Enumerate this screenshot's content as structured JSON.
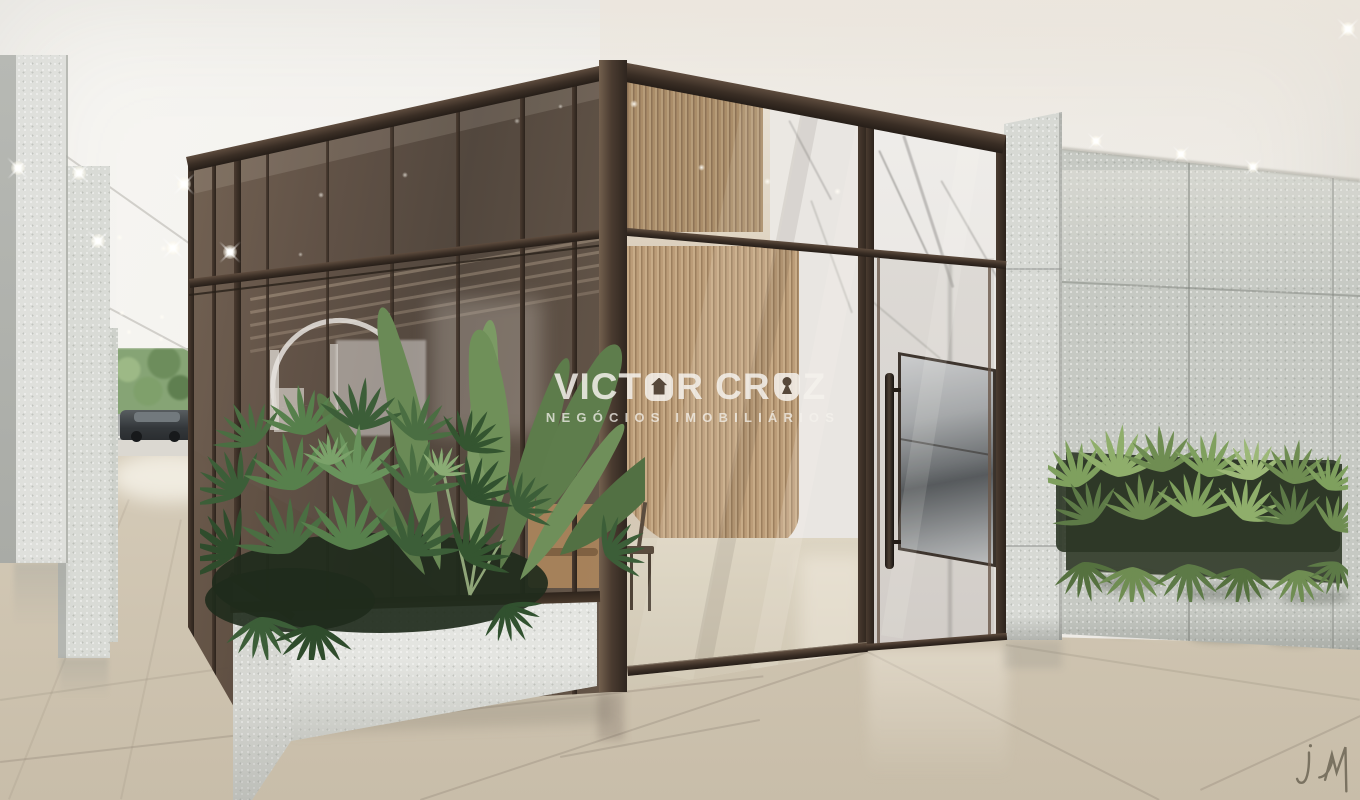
{
  "scene": {
    "kind": "architectural-render",
    "subject": "residential building lobby entrance with bronze-framed glass, marble, stone walls and planters"
  },
  "watermark": {
    "brand_full": "VICTOR CRUZ",
    "brand_part1": "VICT",
    "brand_o_icon": "house-icon",
    "brand_part2": "R CR",
    "brand_u_icon": "keyhole-icon",
    "brand_part3": "Z",
    "subtitle": "NEGÓCIOS IMOBILIÁRIOS"
  },
  "signature": {
    "mark": "jm"
  },
  "palette": {
    "ceiling_white": "#f3f1ed",
    "bronze_frame": "#4a3c31",
    "bronze_dark": "#2f2620",
    "glass_brown": "#5d4d40",
    "wood_slat": "#b79a77",
    "marble_white": "#ebe8e4",
    "terrazzo_light": "#d9dbd6",
    "stone_green_gray": "#c6c9c3",
    "floor_beige": "#d4cab7",
    "floor_far": "#e6e0d4",
    "foliage_dark": "#31512f",
    "foliage_mid": "#57804c",
    "foliage_light": "#8fae6b",
    "car_gray": "#3f4346",
    "watermark_white": "#f4f1ec"
  }
}
